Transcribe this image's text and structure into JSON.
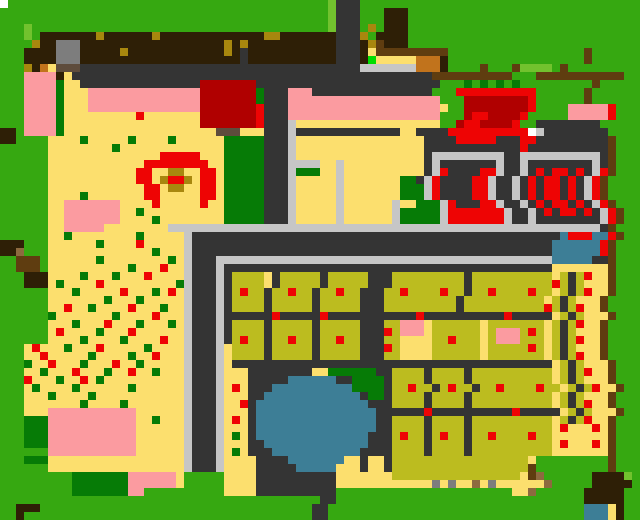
{
  "map": {
    "cols": 80,
    "rows": 65,
    "cell_px": 8,
    "palette": {
      "G": "#36a811",
      "g": "#72c22e",
      "D": "#067b06",
      "N": "#00dd00",
      "Y": "#fcdf6e",
      "O": "#bcbc1f",
      "R": "#ee0404",
      "r": "#b00000",
      "P": "#fb9ba0",
      "K": "#343434",
      "L": "#c6c6c6",
      "M": "#7d7d7d",
      "B": "#2e1f06",
      "b": "#5f3d10",
      "t": "#a8870e",
      "c": "#c1731c",
      "U": "#3d7e96",
      "W": "#ffffff",
      "n": "#5e4c3c",
      "h": "#8d6a3f"
    },
    "grid": [
      "WGGGGGGGGGGGGGGGGGGGGGGGGGGGGGGGGGGGGGGGGgKKKGGGGGGGGGGGGGGGGGGGGGGGGGGGGGGGGGG",
      "GGGGGGGGGGGGGGGGGGGGGGGGGGGGGGGGGGGGGGGGGgKKKGGGBBBGGGGGGGGGGGGGGGGGGGGGGGGGGGG",
      "GGGGGGGGGGGGGGGGGGGGGGGGGGGGGGGGGGGGGGGGGgKKKGGGBBBGGGGGGGGGGGGGGGGGGGGGGGGGGGG",
      "GGGgGGGGGGGGGGGGGGGGGGGGGGGGGGGGGGGGGGGGGgKKKGtGBBBGGGGGGGGGGGGGGGGGGGGGGGGGGGG",
      "GGGgGBBBBBBBtBBBBBBtBBBBBBBBBBBBBttBBBBBBBKKKtGBBBBGGGGGGGGGGGGGGGGGGGGGGGGGGGG",
      "GGGGtBBMMMBBBBBBBBBBBBBBBBBBtBtBBBBBBBBBBBKKKBtbBBBGGGGGGGGGGGGGGGGGGGGGGGGGGGG",
      "GGGBBBBMMMBBBBBtBBBBBBBBBBBBtBKBBBBBBBBBBBKKKBYbbbbbbbbbGGGGGGGGGGGGGGGGGbGGGGG",
      "GGGBBBBMMMBBBBBBBBBBBBBBBBBBBBKBBBBBBBBBBBKKKBNYYYYYcccBGGGGGGGGGGGGGGGGGbGGGGG",
      "GGGtBcYnnnKKKKKKKKKKKKKKKKKKKKKKKKKKKKKKKKKKKLLLLLLLcccBGGGGbGGGbggggGbGGGGG",
      "GGGPPPPBYKKKKKKKKKKKKKKKKKKKKKKKKKKKKKKKKKKKKKKKKKKKKKbbbbbbbbbbGGGbbbbbbbbbbbG",
      "GGGPPPPDYYKKKKKKKKKKKKKKKrrrrrrrKKKKKKKKKKKKKKKKKKKKKKKGGGDGDGDGDGGGGGGGGGbGGGGG",
      "GGGPPPPDYYYPPPPPPPPPPPPPPrrrrrrrDKKKPPPKKKKKKKKKKKKKKKGGGRRRRRRRRRRGGGGGGbGGGGG",
      "GGGPPPPDYYYPPPPPPPPPPPPPPrrrrrrrDKKKPPPPPPPPPPPPPPPPPPPGGGrrrrrrrrRGGGGGGbGGGGG",
      "GGGPPPPDYYYPPPPPPPPPPPPPPrrrrrrrRKKKPPPPPPPPPPPPPPPPPPPYGGrrrrrrrrRGGGGPPPPPRGG",
      "GGGPPPPDYYYYYYYYYRYYYYYYYrrrrrrrRKKKPPPPPPPPPPPPPPPPPPPGGGrRRrrrrRGGGGGPPPPPRGG",
      "GGGPPPPDYYYYYYYYYYYYYYYYYrrrrrrrRKKKLYYYYYYYYYYYYYYYYYYGGrRRrrrrRGGKKKKKKKKGG",
      "BBGPPPPDYYYYYYYYYYYYYYYYYYYnnnYYYKKKLKKKKKKKKKKKKKYYKKKKRRRRRRRRRRWLKKKKKKKKGG",
      "BBGGGGYYYYDYYYYYDYYYYDYYYYYYDDDDDKKKLYYYYYYYYYYYYYYYYKKKKRRRRRKKKRRKKKKKKKKKbGG",
      "GGGGGGYYYYYYYYDYYYYYYYYYYYYYDDDDDKKKLYYYYYYYYYYYYYYYYKKKKKKKKKKKKRKKKKKKKKKKbGG",
      "GGGGGGYYYYYYYYYYYYYYRRRRRYYYDDDDDKKKLYYYYYYYYYYYYYYYYKLLLLLLLLLKKLLLLLLLLLLKbGG",
      "GGGGGGYYYYYYYYYYYYRRRRRRRRYYDDDDDKKKLLLLYYLYYYYYYYYYYKLKKKKKKKLKKLKKKKKKKKLKbGG",
      "GGGGGGYYYYYYYYYYYRRYYttYYRRYDDDDDKKKLDDDYYLYYYYYYYYYYKLRKKKKRRLKKLKRKRRKRKLRbGG",
      "GGGGGGYYYYYYYYYYYRRYtRRtYRRYDDDDDKKKLYYYYYLYYYYYYYDDKLRKKKKRRLKKLKRKRRKRKLRbGG",
      "GGGGGGYYYYYYYYYYYYRRYttYYRRYDDDDDKKKLYYYYYLYYYYYYYDDDLRKKKKRRLKKLKRKRRKRKLRbGG",
      "GGGGGGYYYYDYYYYYYYRRYYYYYRRYDDDDDKKKLYYYYYLYYYYYYYDDDLRKKKKRRLKKLKRKRRKRKLRbGG",
      "GGGGGGYYPPPPPPPYYYYRYYYYYRYYDDDDDKKKLYYYYYLYYYYYYLYYDDDLRKKKRRLKKLKRKRRKRKLRbGG",
      "GGGGGGYYPPPPPPPYYDYYYYYYYYYYDDDDDKKKLYYYYYLYYYYYYLDDDDDLRRRRRRRLKKLKRKRRKRKLRbGG",
      "GGGGGGYYPPPPPPPYYYYDYYYYYYYYDDDDDKKKLYYYYYLYYYYYYLDDDDDLRRRRRRRLKKLKKKKKKKKLRbGG",
      "GGGGGGYYPPPPPYYYYYYYYLLLLLLLLLLLLLLLLLLLLLLLLLLLLLLLLLLLLLLLLLLLLLLLLLLLLLLKbGG",
      "GGGGGGYYDYYYYYYYYDYYYYYLKKKKKKKKKKKKKKKKKKKKKKKKKKKKKKKKKKKKKKKKKKKKKKURRRUURbGG",
      "BBBGGGYYYYYYDYYYYRYYYYYLKKKKKKKKKKKKKKKKKKKKKKKKKKKKKKKKKKKKKKKKKKKKKUUUUUURbGG",
      "BBhGGGYYYYYYYYYYYYYDYYYLKKKKKKKKKKKKKKKKKKKKKKKKKKKKKKKKKKKKKKKKKKKKKUUUUUURbGG",
      "GGbbbGYYYYYYDYYYYYYYYDYLKKKLLLLLLLLLLLLLLLLLLLLLLLLLLLLLLLLLLLLLLLLLLUUUUUKKbGG",
      "GGbbbGYYYYYYYYYYDYYYRYYLKKKLKKKKKKKKKKKKKKKKKKKKKKKKKKKKKKKKKKKKKKKKKYYYYYYYbGG",
      "GGGBBBYYYYDYYYDYYYRYYYYLKKKLKOOOOYKOOOOOKOOOOOKKKOOOOOOOOOKOOOOOOOOOOYOKORYYbGG",
      "GGGBBBYDYYYYRYYYYYYYYYDLKKKLKOOOOYKOOOOOKOOOOOKKKOOOOOOOOOKOOOOOOOOOOROKOYYYbGG",
      "GGGGGGYYYDYYYYYRYYYDYRYLKKKLKOROOKOOROOKOOROOKKKOOROOOOROOKOOROOOOROOYOKORYYbGG",
      "GGGGGGYYYYYYYDYYYDYYYYYLKKKLKOOOOKOOOOOKOOOOOKKKOOOOOOOOOKOOOOOOOOOOYOKOYYYbGG",
      "GGGGGGYYRYYDYYYYRYYYDYYLKKKLKOOOOKOOOOOKOOOOOKKKOOOOOOOOOKOOOOOOOOOOROKORYYbGG",
      "GGGGGGDYYYYYYYDYYYYRYYYLKKKLKKKKKKRKKKKKRKKKKKKKKKKKRKKKKKKKKKKRKKKKKYOKOYYYbGG",
      "GGGGGGYYYDYYYRYYYDYYYDYLKKKLKOOOOKOOOOOKOOOOOKKKOOPPPYOOOOOOYOOOOOOOYOKORYYbGG",
      "GGGGGGYRYYYYDYYYRYYYYYYLKKKLKOOOOKOOOOOKOOOOOKKKROPPPYOOOOOOYOPPPOROYOKOYYYbGG",
      "GGGGGGYYYYDYYYYDYYYYRYYLKKKLKOROOKOOROOKOOROOKKKOOYYYYOOROOOYOPPPOOOYOKORYYbGG",
      "GGGYRYYYDYYYRYYYYYDYYYYLKKKLYOOOOKOOOOOKOOOOOKKKROYYYYOOOOOOYOOOOOROYOKOYYYbGG",
      "GGGYYRYYYYYDYYYYDYYRYYYLKKKLYOOOOKOOOOOKOOOOOKKKOOYYYYOOOOOOYOOOOOOOYOKORYYbGG",
      "GGGDYYRYYYDYYYRYYDYYYYYLKKKLYKKKKKKKKKKKKKKKKKKKKKKKKKKKKKKKKKKKKKKKKYOKOYYYbGG",
      "GGGYYDYYYRYYYDYYRYYDYYYLKKKLYYYKKKKKKKKYYDDDDDDKKOOOOKOOOOKOOOOOOOOOOYOKORYYbGG",
      "GGGRYYYDYYRYDYYYYYYYYYYLKKKLYYYKKKKKUUUUUUKKDDDDKOOOOKOOOOKOOOOOOOOOOYOKOYYYbGG",
      "GGGYDYYYYDYYYYYYDYYYYYYLKKKLYRYKKKUUUUUUUUUUDDDDKOOROOKOROOKOOROOOOROOYOKORYYbGG",
      "GGGYYYDYYYYDYYYYYYYYYYYLKKKLYYYKKUUUUUUUUUUUUKDDKOOOOKOOOOKOOOOOOOOOOYOKOYYYbGG",
      "GGGYYYYYYYDYYYYDYYYYYYYLKKKLYYRKUUUUUUUUUUUUUUKKKOOOOKOOOOKOOOOOOOOOOYOKORYYbGG",
      "GGGYYYPPPPPPPPPPPYYYYYYLKKKLYYYKUUUUUUUUUUUUUUUKKKKKKRKKKKKKKKKKRKKKKKYOKOYYYbGG",
      "GGGDDDPPPPPPPPPPPYYDYYYLKKKLYRYKUUUUUUUUUUUUUUUKKOOOOKOOOOKOOOOOOOOOOYOKORYYbGG",
      "GGGDDDPPPPPPPPPPPYYYYYYLKKKLYYYKUUUUUUUUUUUUUUUKKOOOOKOOOOKOOOOOOOOOOYRYYYRYbGG",
      "GGGDDDPPPPPPPPPPPYYYYYYLKKKLYDYKUUUUUUUUUUUUUUKKKOROOKOROOKOOROOOOROOYYYYYYYbGG",
      "GGGDDDPPPPPPPPPPPYYYYYYLKKKLYYYKKUUUUUUUUUUUUUKKKOOOOKOOOOKOOOOOOOOOOYRYYYRYbGG",
      "GGGGGGPPPPPPPPPPPYYYYYYLKKKLYDYKKKUUUUUUUUUUUKKKKOOOOKOOOOKOOOOOOOOOOYYYYYYYbGG",
      "GGGDDDYYYYYYYYYYYYYYYYYLKKKLYYYYKKKKUUUUUUUYYKYYKOOOOOOOOOOOOOOOOOYGGGGGGGGGbGG",
      "GGGGGGYYYYYYYYYYYYYYYYYLKKKLYYYYKKKKKUUUUUYYYKYYKOOOOOOOOOOOOOOOOObGGGGGGGGGbGG",
      "GGGGGGGGGDDDDDDDPPPPPPYGGGGGYYYYKKKKKKKKKKYYYYYYYOOOOOOOOOOOOOOOOYbhGGGGGGBBBBg",
      "GGGGGGGGGDDDDDDDPPPPPPYGGGGGYYYYKKKKKKKKKKYYYYYYYYYYYYMYMYYhYMYYYYYYhGGGGGBBBBB",
      "GGGGGGGGGDDDDDDDPPGGGGGGGGGGYYYYKKKKKKKKKKGGGGGGGGGGGGGGGGGGGGGGYYhGGGGGGBBBBB",
      "GGGGGGGGGGGGGGGGGGGGGGGGGGGGGGGGGGGGGGGGKKGGGGGGGGGGGGGGGGGGGGGGGGGGGGGGGBBBBB",
      "GGBBBGGGGGGGGGGGGGGGGGGGGGGGGGGGGGGGGGGKKGGGGGGGGGGGGGGGGGGGGGGGGGGGGGGGGUUUYB",
      "GGBGGGGGGGGGGGGGGGGGGGGGGGGGGGGGGGGGGGGKKGGGGGGGGGGGGGGGGGGGGGGGGGGGGGGGGUUUYB"
    ]
  },
  "regions": [
    {
      "name": "orchard-top-band",
      "x": 40,
      "y": 32,
      "w": 296,
      "h": 32
    },
    {
      "name": "grey-shed",
      "x": 56,
      "y": 40,
      "w": 24,
      "h": 24
    },
    {
      "name": "red-house-left",
      "x": 200,
      "y": 80,
      "w": 64,
      "h": 48
    },
    {
      "name": "red-house-right",
      "x": 464,
      "y": 88,
      "w": 80,
      "h": 52
    },
    {
      "name": "market-stall-left",
      "x": 440,
      "y": 152,
      "w": 72,
      "h": 80
    },
    {
      "name": "market-stall-right",
      "x": 528,
      "y": 152,
      "w": 80,
      "h": 80
    },
    {
      "name": "blue-kiosk",
      "x": 560,
      "y": 224,
      "w": 48,
      "h": 40
    },
    {
      "name": "crop-plots-left",
      "x": 232,
      "y": 264,
      "w": 144,
      "h": 96
    },
    {
      "name": "crop-plots-right",
      "x": 392,
      "y": 264,
      "w": 168,
      "h": 200
    },
    {
      "name": "flower-stand-right",
      "x": 560,
      "y": 264,
      "w": 56,
      "h": 200
    },
    {
      "name": "pond",
      "x": 256,
      "y": 376,
      "w": 128,
      "h": 96
    },
    {
      "name": "flower-field",
      "x": 24,
      "y": 72,
      "w": 200,
      "h": 312
    },
    {
      "name": "pink-blanket-top",
      "x": 64,
      "y": 200,
      "w": 56,
      "h": 32
    },
    {
      "name": "pink-blanket-large",
      "x": 48,
      "y": 408,
      "w": 88,
      "h": 48
    },
    {
      "name": "pink-blanket-small",
      "x": 128,
      "y": 472,
      "w": 48,
      "h": 24
    },
    {
      "name": "path-top-horizontal",
      "x": 80,
      "y": 64,
      "w": 360,
      "h": 32
    },
    {
      "name": "path-main-vertical",
      "x": 264,
      "y": 64,
      "w": 24,
      "h": 168
    },
    {
      "name": "dock-bottom-right",
      "x": 600,
      "y": 472,
      "w": 40,
      "h": 48
    }
  ]
}
